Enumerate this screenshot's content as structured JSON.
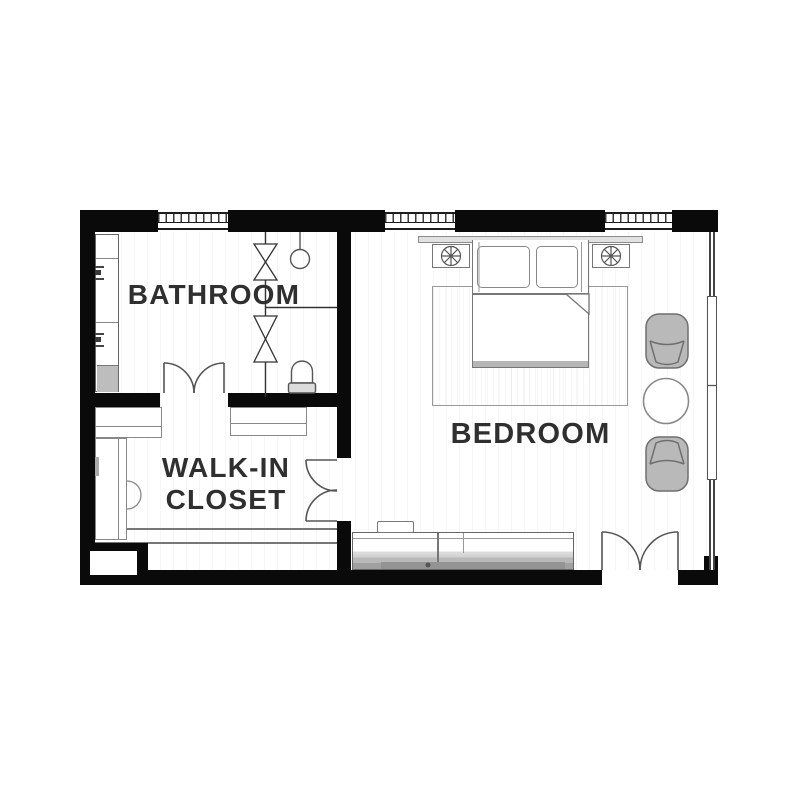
{
  "document": {
    "type": "floor-plan"
  },
  "rooms": {
    "bathroom": {
      "label": "BATHROOM"
    },
    "walk_in_closet": {
      "line1": "WALK-IN",
      "line2": "CLOSET"
    },
    "bedroom": {
      "label": "BEDROOM"
    }
  },
  "symbols": [
    "window",
    "double-door",
    "shower-partition",
    "shower-door",
    "shower-head",
    "toilet",
    "vanity-sink",
    "closet-shelf",
    "closet-rod",
    "bed",
    "pillow",
    "headboard",
    "nightstand",
    "table-lamp",
    "rug",
    "armchair",
    "round-table",
    "dresser"
  ],
  "colors": {
    "wall": "#0a0a0a",
    "label_text": "#2f2f2f",
    "line": "#666666",
    "chair_fill": "#b9b9b9",
    "background": "#ffffff"
  }
}
